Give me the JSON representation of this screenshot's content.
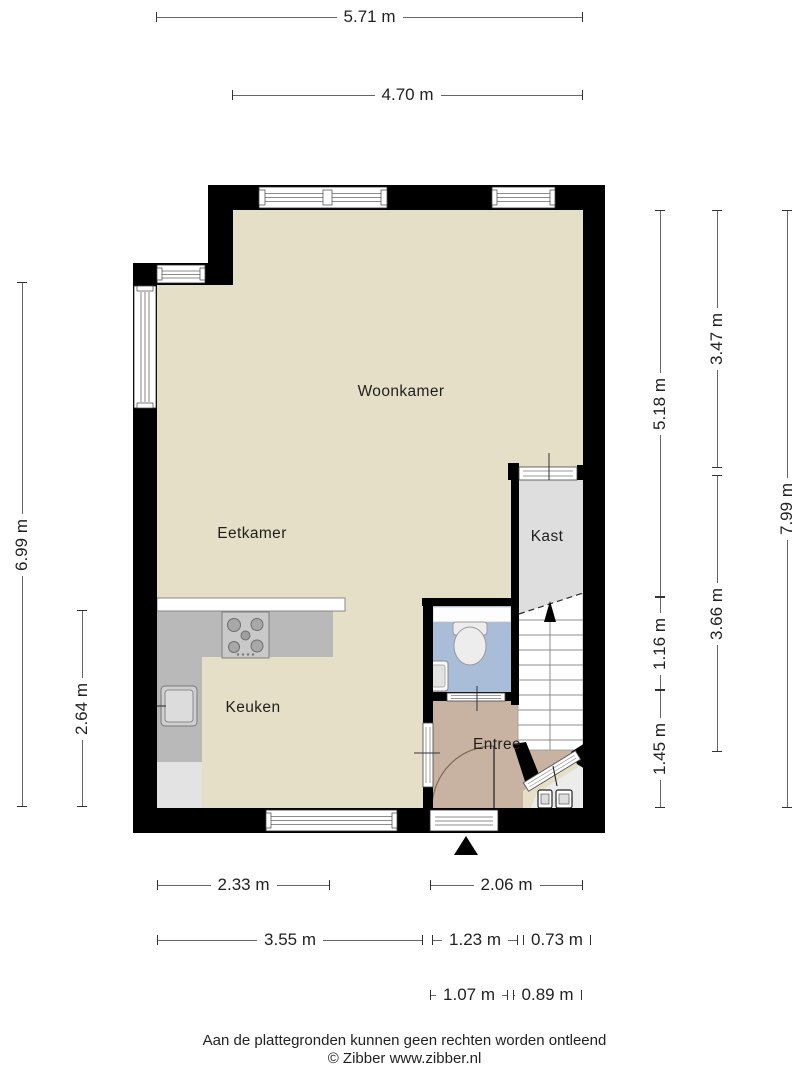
{
  "title": "Plattegrond begane grond",
  "rooms": {
    "woonkamer": {
      "label": "Woonkamer"
    },
    "eetkamer": {
      "label": "Eetkamer"
    },
    "keuken": {
      "label": "Keuken"
    },
    "kast": {
      "label": "Kast"
    },
    "entree": {
      "label": "Entree"
    }
  },
  "dimensions": {
    "horizontal": [
      {
        "label": "5.71 m",
        "x": 156,
        "y": 17,
        "length": 427
      },
      {
        "label": "4.70 m",
        "x": 232,
        "y": 95,
        "length": 351
      },
      {
        "label": "2.33 m",
        "x": 157,
        "y": 885,
        "length": 173
      },
      {
        "label": "2.06 m",
        "x": 430,
        "y": 885,
        "length": 153
      },
      {
        "label": "3.55 m",
        "x": 157,
        "y": 940,
        "length": 266
      },
      {
        "label": "1.23 m",
        "x": 432,
        "y": 940,
        "length": 86
      },
      {
        "label": "0.73 m",
        "x": 523,
        "y": 940,
        "length": 60
      },
      {
        "label": "1.07 m",
        "x": 430,
        "y": 995,
        "length": 78
      },
      {
        "label": "0.89 m",
        "x": 513,
        "y": 995,
        "length": 69
      }
    ],
    "vertical": [
      {
        "label": "6.99 m",
        "x": 22,
        "y": 282,
        "length": 525
      },
      {
        "label": "2.64 m",
        "x": 82,
        "y": 610,
        "length": 197
      },
      {
        "label": "5.18 m",
        "x": 660,
        "y": 210,
        "length": 387
      },
      {
        "label": "1.16 m",
        "x": 660,
        "y": 597,
        "length": 93
      },
      {
        "label": "1.45 m",
        "x": 660,
        "y": 690,
        "length": 118
      },
      {
        "label": "3.47 m",
        "x": 717,
        "y": 210,
        "length": 258
      },
      {
        "label": "3.66 m",
        "x": 717,
        "y": 475,
        "length": 277
      },
      {
        "label": "7.99 m",
        "x": 787,
        "y": 210,
        "length": 598
      }
    ]
  },
  "footer": {
    "disclaimer": "Aan de plattegronden kunnen geen rechten worden ontleend",
    "credit": "© Zibber www.zibber.nl"
  },
  "colors": {
    "wall": "#000000",
    "floor_main": "#e5dfc8",
    "floor_entree": "#c8b3a3",
    "floor_wc": "#a9bdd9",
    "floor_kast": "#dedede",
    "floor_closet": "#ececec",
    "counter": "#b9b9b9",
    "counter_light": "#e3e3e3",
    "dim_line": "#666666",
    "label_text": "#1f1f1f"
  }
}
